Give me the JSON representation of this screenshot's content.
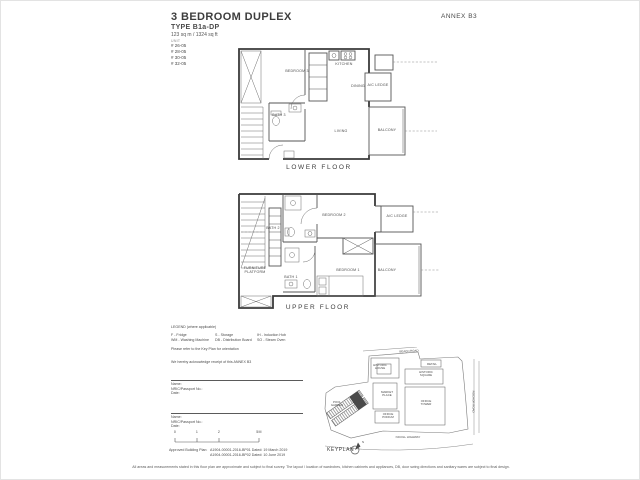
{
  "header": {
    "annex": "ANNEX B3",
    "title": "3 BEDROOM DUPLEX",
    "unit_type": "TYPE B1a-DP",
    "area": "123 sq m / 1324 sq ft",
    "unit_label": "UNIT",
    "units": [
      "# 26-05",
      "# 28-05",
      "# 30-05",
      "# 32-05"
    ]
  },
  "lower_floor": {
    "caption": "LOWER FLOOR",
    "rooms": {
      "bedroom3": "BEDROOM 3",
      "bath3": "BATH 3",
      "kitchen": "KITCHEN",
      "dining": "DINING",
      "living": "LIVING",
      "balcony": "BALCONY",
      "ac_ledge": "A/C LEDGE"
    }
  },
  "upper_floor": {
    "caption": "UPPER FLOOR",
    "rooms": {
      "bath2": "BATH 2",
      "bedroom2": "BEDROOM 2",
      "ac_ledge": "A/C LEDGE",
      "furniture_platform": "FURNITURE PLATFORM",
      "bath1": "BATH 1",
      "bedroom1": "BEDROOM 1",
      "balcony": "BALCONY"
    }
  },
  "legend": {
    "title": "LEGEND (where applicable)",
    "items": [
      "F - Fridge",
      "S - Storage",
      "IH - Induction Hob",
      "WM - Washing Machine",
      "DB - Distribution Board",
      "SO - Steam Oven"
    ],
    "orientation_note": "Please refer to the Key Plan for orientation",
    "acknowledgement": "We hereby acknowledge receipt of this ANNEX B3"
  },
  "signature_blocks": [
    {
      "name": "Name:",
      "nric": "NRIC/Passport No.:",
      "date": "Date:"
    },
    {
      "name": "Name:",
      "nric": "NRIC/Passport No.:",
      "date": "Date:"
    }
  ],
  "scale_bar": {
    "ticks": [
      "0",
      "1",
      "2",
      "5M"
    ]
  },
  "approval": {
    "label": "Approved Building Plan:",
    "line1": "A1904-00001-2016-BP01   Dated: 19 March 2019",
    "line2": "A1904-00001-2016-BP02   Dated: 10 June 2019"
  },
  "keyplan": {
    "caption": "KEYPLAN",
    "north_label": "N",
    "roads": {
      "top": "BEACH ROAD",
      "bottom": "NICOLL HIGHWAY",
      "right": "ROCHOR ROAD"
    },
    "buildings": {
      "historic_house": "HISTORIC HOUSE",
      "retail": "RETAIL",
      "historic_square": "HISTORIC SQUARE",
      "market_place": "MARKET PLACE",
      "office_tower": "OFFICE TOWER",
      "office_podium": "OFFICE PODIUM",
      "pool_garden": "POOL GARDEN"
    }
  },
  "disclaimer": "All areas and measurements stated in this floor plan are approximate and subject to final survey. The layout / location of wardrobes, kitchen cabinets and appliances, DB, door swing directions and sanitary wares are subject to final design.",
  "colors": {
    "wall": "#3a3a3a",
    "thin_line": "#6e6e6e",
    "text": "#4a4a4a",
    "unit_marker": "#4a4a4a"
  }
}
